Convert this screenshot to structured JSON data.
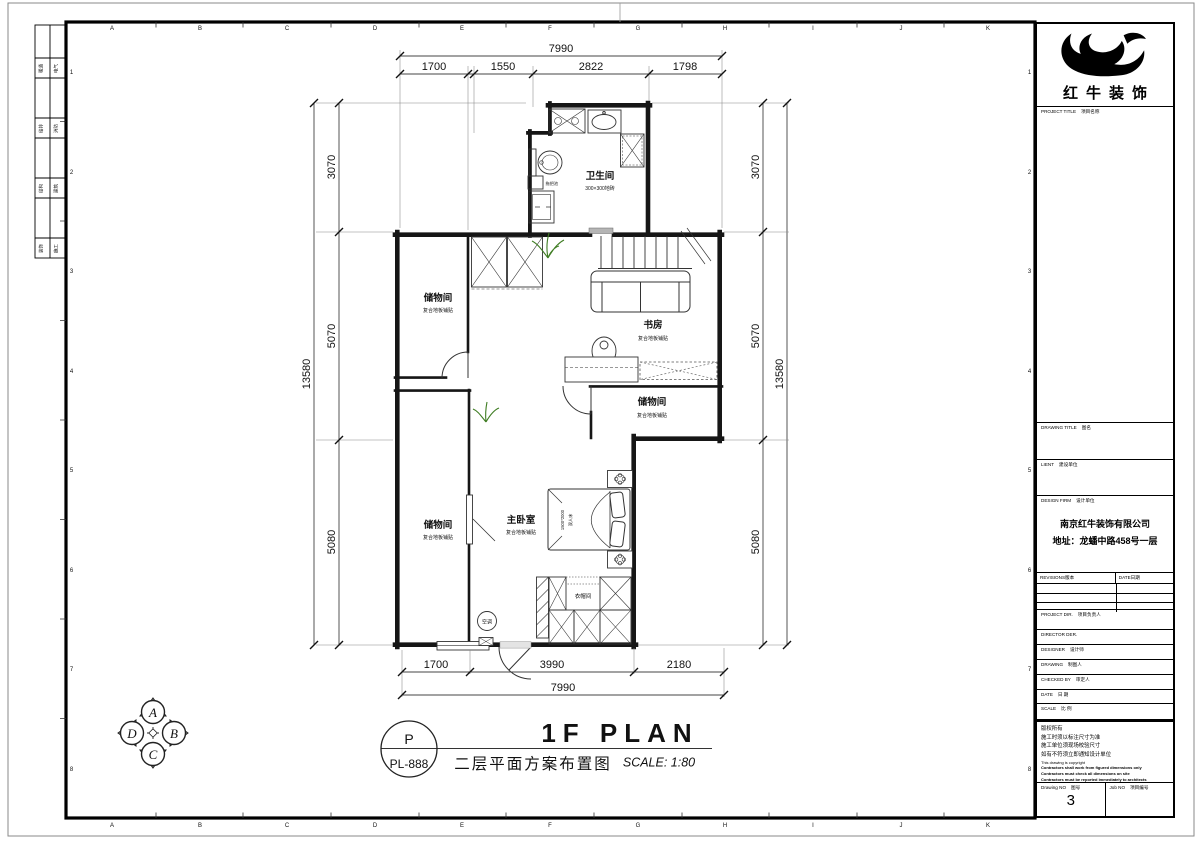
{
  "sheet": {
    "grid_letters": [
      "A",
      "B",
      "C",
      "D",
      "E",
      "F",
      "G",
      "H",
      "I",
      "J",
      "K"
    ],
    "grid_numbers": [
      "1",
      "2",
      "3",
      "4",
      "5",
      "6",
      "7",
      "8"
    ],
    "signature_cells": [
      [
        "暖通",
        "电气"
      ],
      [
        "给排",
        "消防"
      ],
      [
        "结构",
        "建筑"
      ],
      [
        "装饰",
        "施工"
      ]
    ]
  },
  "plan": {
    "rooms": [
      {
        "name": "卫生间",
        "sub": "300×300地砖"
      },
      {
        "name": "储物间",
        "sub": "复合地板铺贴"
      },
      {
        "name": "书房",
        "sub": "复合地板铺贴"
      },
      {
        "name": "储物间",
        "sub": "复合地板铺贴"
      },
      {
        "name": "储物间",
        "sub": "复合地板铺贴"
      },
      {
        "name": "主卧室",
        "sub": "复合地板铺贴"
      },
      {
        "name": "衣帽间"
      }
    ],
    "labels": {
      "mop_sink": "拖把池",
      "ac": "空调",
      "bed_size": "1500*2000",
      "bed_type": "双人床"
    },
    "dims": {
      "top_total": "7990",
      "top": [
        "1700",
        "1550",
        "2822",
        "1798"
      ],
      "bottom": [
        "1700",
        "3990",
        "2180"
      ],
      "bottom_total": "7990",
      "left": [
        "3070",
        "5070",
        "5080"
      ],
      "left_total": "13580",
      "right": [
        "3070",
        "5070",
        "5080"
      ],
      "right_total": "13580"
    }
  },
  "annotation": {
    "tag_letter": "P",
    "tag_code": "PL-888",
    "title_en": "1F PLAN",
    "title_cn": "二层平面方案布置图",
    "scale": "SCALE: 1:80"
  },
  "compass": {
    "letters": [
      "A",
      "B",
      "C",
      "D"
    ]
  },
  "titleblock": {
    "logo_text": "红牛装饰",
    "project_title": {
      "en": "PROJECT TITLE",
      "cn": "项目名称"
    },
    "drawing_title": {
      "en": "DRAWING TITLE",
      "cn": "图名"
    },
    "client": {
      "en": "LIENT",
      "cn": "建设单位"
    },
    "design_firm": {
      "en": "DESIGN FIRM",
      "cn": "设计单位",
      "company": "南京红牛装饰有限公司",
      "address": "地址：龙蟠中路458号一层"
    },
    "revisions": {
      "en": "REVISIONS",
      "cn": "版本",
      "date_en": "DATE",
      "date_cn": "日期"
    },
    "rows": [
      {
        "en": "PROJECT DIR.",
        "cn": "项目负责人"
      },
      {
        "en": "DIRECTOR DER.",
        "cn": ""
      },
      {
        "en": "DESIGNER",
        "cn": "设计师"
      },
      {
        "en": "DRAWING",
        "cn": "制图人"
      },
      {
        "en": "CHECKED BY",
        "cn": "审定人"
      },
      {
        "en": "DATE",
        "cn": "日 期"
      },
      {
        "en": "SCALE",
        "cn": "比 例"
      }
    ],
    "notes_cn": [
      "版权所有",
      "施工时须以标注尺寸为准",
      "施工单位须现场校验尺寸",
      "如有不符须立即通知设计单位"
    ],
    "notes_en": [
      "This drawing is copyright",
      "Contractors shall work from figured dimensions only",
      "Contractors must check all dimensions on site",
      "Contractors must be reported immediately to architects"
    ],
    "drawing_no": {
      "en": "Drawing NO",
      "cn": "图号",
      "value": "3"
    },
    "job_no": {
      "en": "Job NO",
      "cn": "项目编号"
    }
  }
}
